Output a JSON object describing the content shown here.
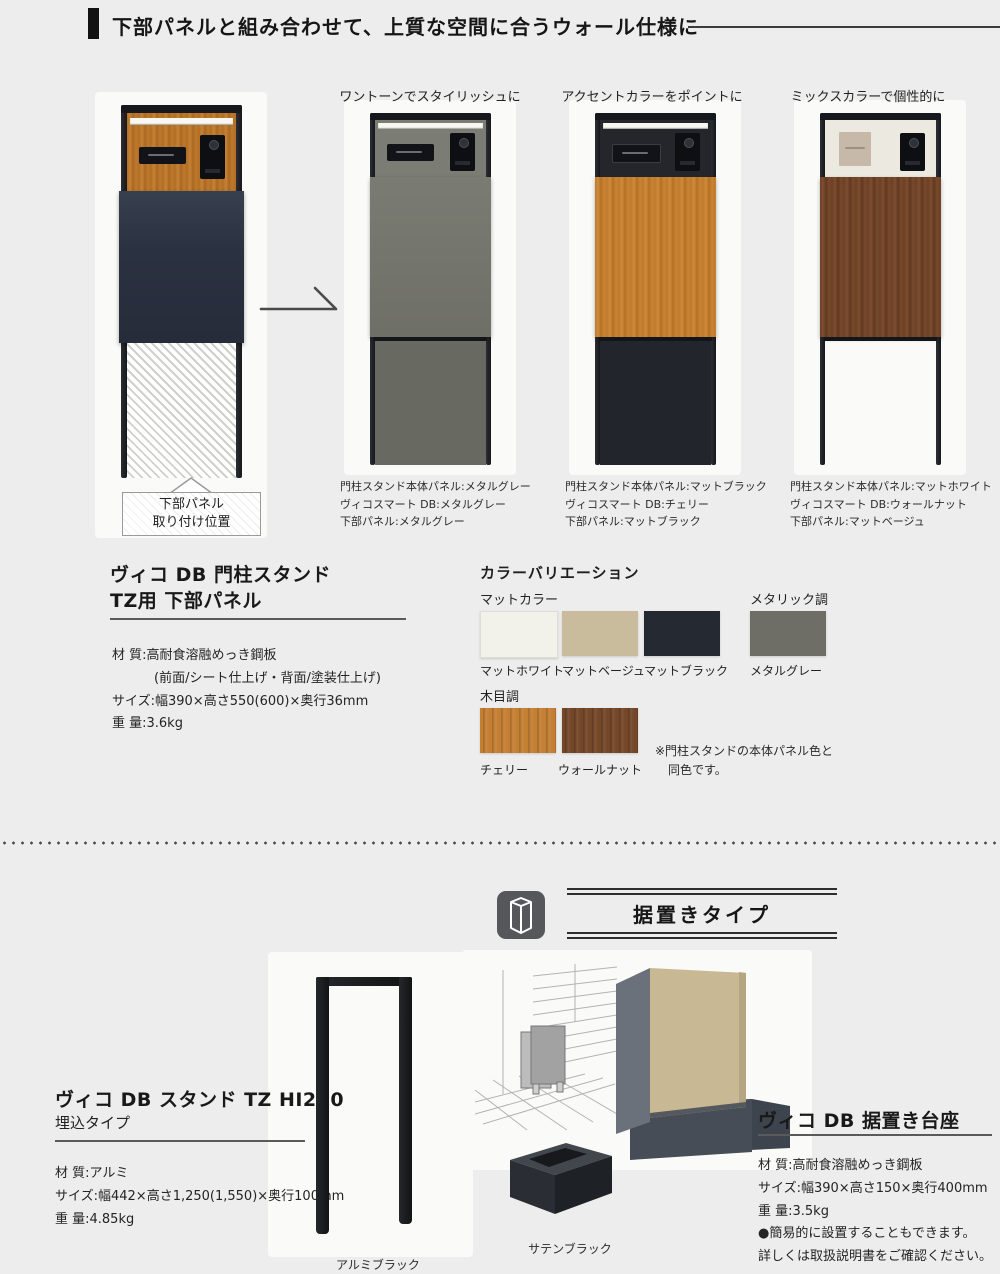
{
  "header": {
    "title": "下部パネルと組み合わせて、上質な空間に合うウォール仕様に"
  },
  "wall": {
    "base": {
      "callout_line1": "下部パネル",
      "callout_line2": "取り付け位置"
    },
    "variants": [
      {
        "label": "ワントーンでスタイリッシュに",
        "caption": [
          "門柱スタンド本体パネル:メタルグレー",
          "ヴィコスマート DB:メタルグレー",
          "下部パネル:メタルグレー"
        ]
      },
      {
        "label": "アクセントカラーをポイントに",
        "caption": [
          "門柱スタンド本体パネル:マットブラック",
          "ヴィコスマート DB:チェリー",
          "下部パネル:マットブラック"
        ]
      },
      {
        "label": "ミックスカラーで個性的に",
        "caption": [
          "門柱スタンド本体パネル:マットホワイト",
          "ヴィコスマート DB:ウォールナット",
          "下部パネル:マットベージュ"
        ]
      }
    ]
  },
  "lower_panel": {
    "title_line1": "ヴィコ DB 門柱スタンド",
    "title_line2": "TZ用 下部パネル",
    "specs": [
      "材 質:高耐食溶融めっき鋼板",
      "(前面/シート仕上げ・背面/塗装仕上げ)",
      "サイズ:幅390×高さ550(600)×奥行36mm",
      "重 量:3.6kg"
    ]
  },
  "colors": {
    "title": "カラーバリエーション",
    "matte_group": "マットカラー",
    "metallic_group": "メタリック調",
    "wood_group": "木目調",
    "swatches": {
      "matte": [
        {
          "label": "マットホワイト",
          "hex": "#f2f1ea"
        },
        {
          "label": "マットベージュ",
          "hex": "#c9bc9d"
        },
        {
          "label": "マットブラック",
          "hex": "#252a32"
        }
      ],
      "metallic": [
        {
          "label": "メタルグレー",
          "hex": "#6f6e66"
        }
      ],
      "wood": [
        {
          "label": "チェリー",
          "hex": "#c57f33"
        },
        {
          "label": "ウォールナット",
          "hex": "#744728"
        }
      ]
    },
    "note_line1": "※門柱スタンドの本体パネル色と",
    "note_line2": "同色です。"
  },
  "standing": {
    "badge": "据置きタイプ",
    "stand": {
      "title": "ヴィコ DB スタンド TZ HI250",
      "subtitle": "埋込タイプ",
      "specs": [
        "材 質:アルミ",
        "サイズ:幅442×高さ1,250(1,550)×奥行100mm",
        "重 量:4.85kg"
      ],
      "image_label": "アルミブラック"
    },
    "pedestal_label": "サテンブラック",
    "base": {
      "title": "ヴィコ DB 据置き台座",
      "specs": [
        "材 質:高耐食溶融めっき鋼板",
        "サイズ:幅390×高さ150×奥行400mm",
        "重 量:3.5kg"
      ],
      "notes": [
        "●簡易的に設置することもできます。",
        "詳しくは取扱説明書をご確認ください。"
      ]
    }
  }
}
